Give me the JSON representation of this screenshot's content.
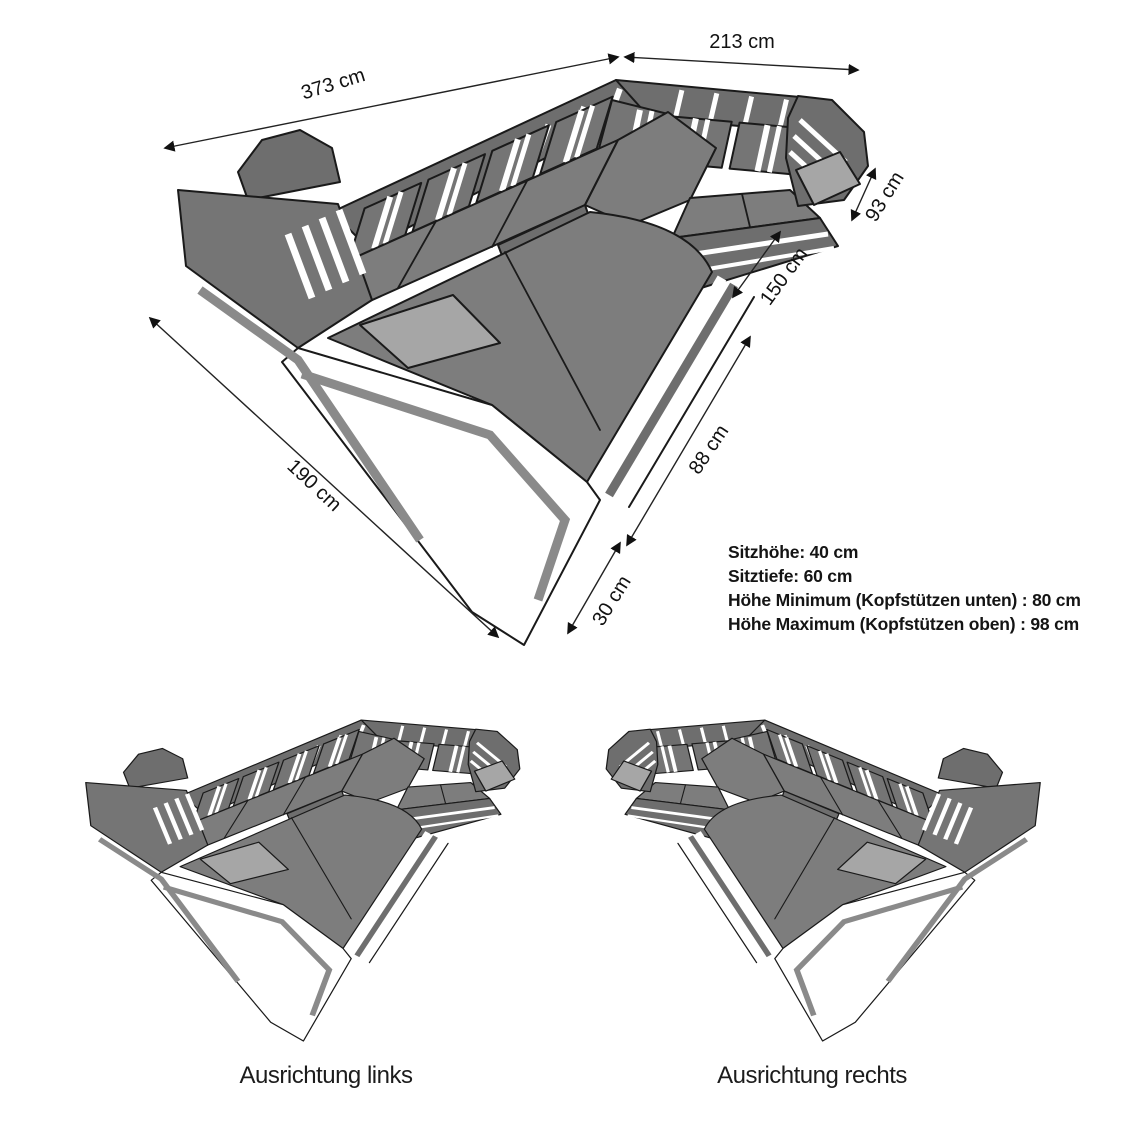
{
  "diagram": {
    "title_context": "Sofa dimension diagram (U-shape sectional)",
    "dimensions": {
      "back_width": "373 cm",
      "right_width": "213 cm",
      "right_arm_depth": "93 cm",
      "right_side_depth": "150 cm",
      "mid_depth": "88 cm",
      "front_depth": "30 cm",
      "left_depth": "190 cm"
    },
    "specs": [
      "Sitzhöhe: 40 cm",
      "Sitztiefe: 60 cm",
      "Höhe Minimum (Kopfstützen unten) : 80 cm",
      "Höhe Maximum (Kopfstützen oben) : 98 cm"
    ],
    "variants": {
      "left_label": "Ausrichtung links",
      "right_label": "Ausrichtung rechts"
    },
    "colors": {
      "background": "#ffffff",
      "sofa_gray_dark": "#6e6e6e",
      "sofa_gray_top": "#7d7d7d",
      "sofa_gray_cushion": "#757575",
      "panel_light_gray": "#a6a6a6",
      "outline": "#1a1a1a",
      "text": "#111111"
    }
  }
}
